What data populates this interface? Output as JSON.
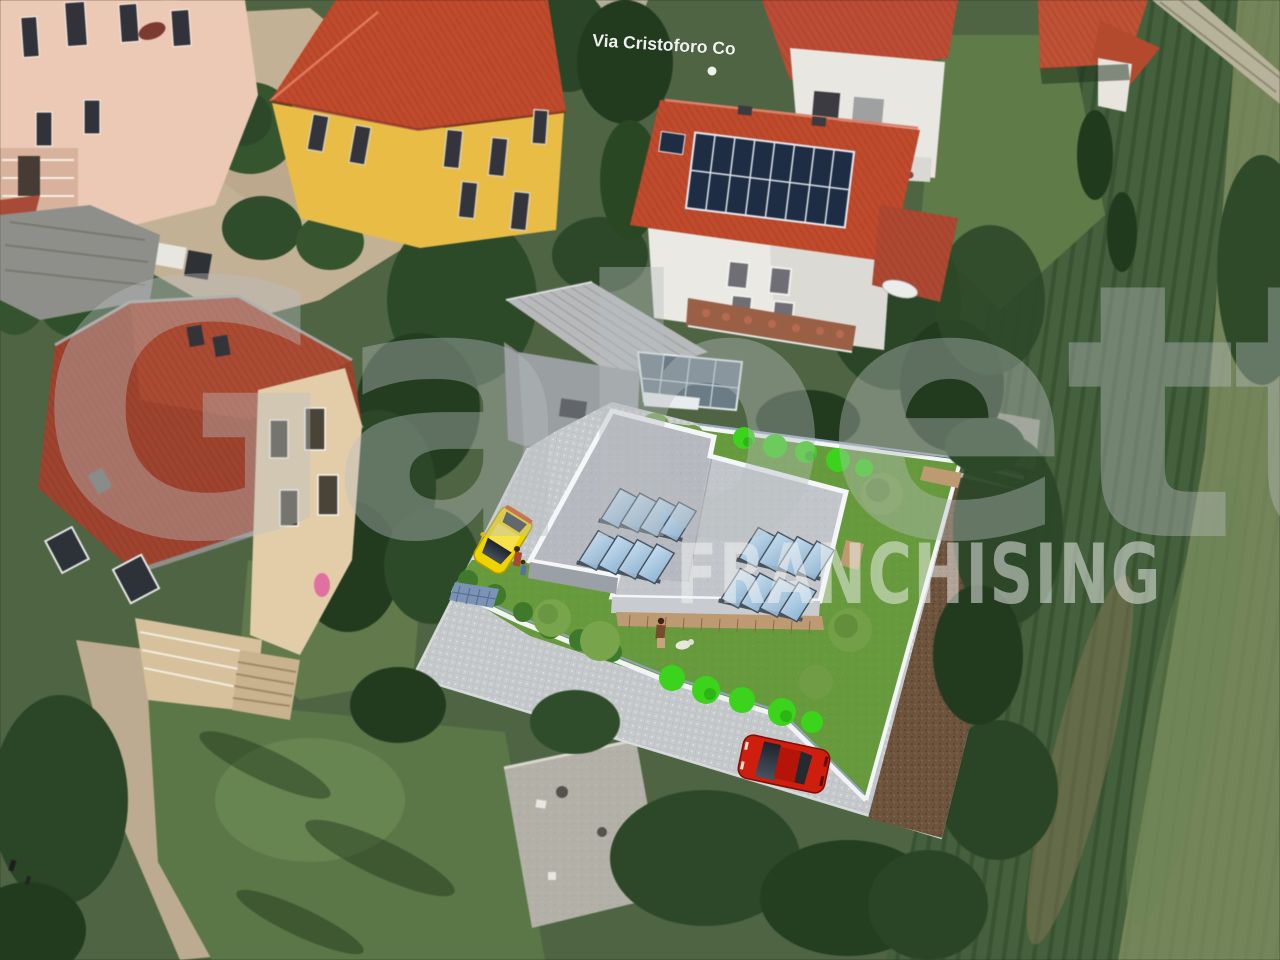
{
  "watermark": {
    "brand": "Gabetti",
    "subtitle": "FRANCHISING"
  },
  "map": {
    "street_label": "Via Cristoforo Co",
    "marker_icon": "street-dot-icon"
  },
  "scene": {
    "description": "Aerial photograph of a residential neighborhood with a superimposed 3D rendering of a planned flat-roof house on an empty plot",
    "existing_features": [
      "pink apartment house",
      "yellow villa with red hip roof",
      "white house with rooftop solar array (2 rows x 8 panels)",
      "white gable house",
      "red-roof cottage",
      "stone villa with red tile roof",
      "metal-roof garage",
      "glass conservatory",
      "concrete shed",
      "gravel courtyard",
      "driveway",
      "tree groups",
      "agricultural field with crop rows"
    ],
    "render_features": [
      "new flat-roof building with four skylight banks",
      "cobblestone plaza",
      "lawn with hedge row and bright shrubs",
      "brown gravel border strip",
      "white boundary walls",
      "yellow hatchback car",
      "red sedan car",
      "woman walking a white dog",
      "two small figures near the yellow car",
      "blue utility grate"
    ]
  },
  "colors": {
    "watermark_brand": "#b9bdc1",
    "watermark_subtitle": "#f3f3f3",
    "street_label": "#ffffff",
    "vegetation_base": "#4f6443",
    "field_green": "#45603c",
    "field_pale_band": "#8d9a6a",
    "tile_roof_red": "#c04a2c",
    "villa_yellow_wall": "#e9bc45",
    "pink_wall": "#ecc9b4",
    "stone_villa_roof": "#9e432e",
    "stone_villa_wall": "#e3cda9",
    "solar_panel_blue": "#1f2d44",
    "render_pavement": "#c7cacd",
    "render_lawn": "#679a3d",
    "render_bush_bright": "#3bd31c",
    "render_gravel_brown": "#6e543c",
    "render_roof_gray": "#c2c6ca",
    "render_parapet_white": "#f4f6f8",
    "skylight_glass": "#9fc3de",
    "car_yellow": "#f0d400",
    "car_red": "#cf1d0e",
    "road_tan": "#c3b196"
  }
}
